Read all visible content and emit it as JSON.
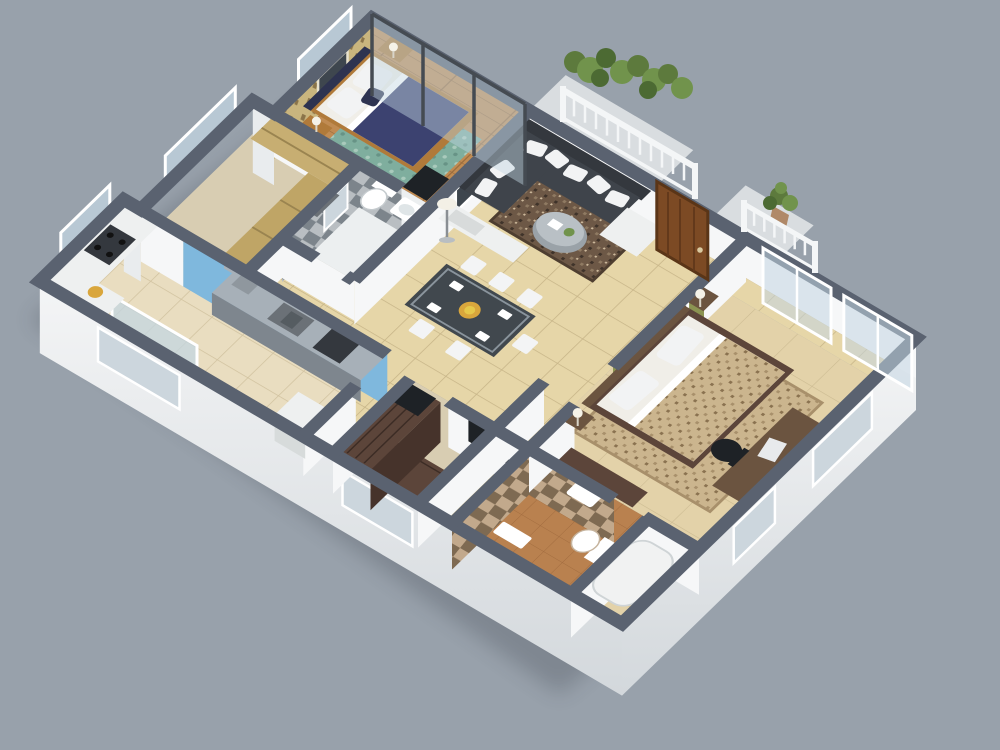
{
  "scene": {
    "type": "3d-isometric-floor-plan-render",
    "rooms": [
      {
        "id": "bedroom-1",
        "floor": "wood",
        "features": [
          "double-bed-navy-duvet",
          "gold-pattern-wallpaper",
          "glass-partition",
          "teal-rug",
          "nightstands",
          "tv"
        ]
      },
      {
        "id": "living-room",
        "floor": "beige-tile",
        "features": [
          "charcoal-corner-sofa",
          "white-pillows",
          "round-coffee-table",
          "brown-rug",
          "tv-console",
          "floor-lamp",
          "wall-art"
        ]
      },
      {
        "id": "balcony",
        "features": [
          "white-railing",
          "planter-shrubs",
          "potted-plant"
        ]
      },
      {
        "id": "entry",
        "features": [
          "wood-door"
        ]
      },
      {
        "id": "dining-area",
        "floor": "beige-tile",
        "features": [
          "glass-dining-table",
          "white-chairs",
          "fruit-plate"
        ]
      },
      {
        "id": "kitchen",
        "floor": "beige-tile",
        "features": [
          "blue-backsplash",
          "steel-counter",
          "sink",
          "gas-stove",
          "fridge",
          "fruit-bowl"
        ]
      },
      {
        "id": "bathroom-1",
        "floor": "white-tile",
        "features": [
          "gray-checker-walls",
          "toilet",
          "basin",
          "mirror"
        ]
      },
      {
        "id": "closet-room",
        "features": [
          "tan-cabinets",
          "window"
        ]
      },
      {
        "id": "master-bedroom",
        "floor": "marble",
        "features": [
          "olive-accent-wall",
          "double-bed-brown-duvet",
          "desk",
          "office-chair",
          "tv-panel",
          "beige-rug",
          "facade-windows"
        ]
      },
      {
        "id": "walk-in-wardrobe",
        "features": [
          "espresso-l-shaped-unit"
        ]
      },
      {
        "id": "bathroom-2",
        "floor": "terracotta",
        "features": [
          "brown-checker-walls",
          "toilet",
          "basin",
          "tub"
        ]
      }
    ]
  },
  "palette": {
    "bg": "#98a1ab",
    "shadow": "#262c34",
    "wall_top": "#5a6270",
    "wall_inner": "#f6f7f8",
    "step_face": "#e9ecee",
    "facade_window": "#ccd6dd",
    "floor_tile": "#e6d6a8",
    "floor_tile_light": "#e9ddc0",
    "floor_wood": "#c08b52",
    "floor_marble": "#e3d2a9",
    "floor_bath": "#eceff0",
    "floor_terracotta": "#b9814f",
    "floor_walkin": "#d8cdb2",
    "balcony_floor": "#d9dde0",
    "rug_teal": "#7fae9e",
    "rug_brown": "#6d5846",
    "rug_master": "#cbb58e",
    "sofa": "#3f444b",
    "sofa_dark": "#34383e",
    "pillow": "#f2f3f4",
    "bed1_duvet": "#3c4270",
    "bed1_head": "#2e3350",
    "bed2_duvet": "#8f7f5c",
    "mattress": "#f0eee8",
    "wood_furniture": "#b07a3a",
    "wood_dark": "#6b5440",
    "espresso": "#5c453a",
    "espresso_face": "#46332b",
    "green_wall": "#8b9352",
    "blue_wall": "#7fb8dd",
    "counter_steel": "#a7b0b8",
    "counter_steel_dark": "#7e868e",
    "steel_dark": "#6b7177",
    "cabinet_tan": "#c7ae72",
    "cabinet_tan_dark": "#bfa566",
    "white_furniture": "#eef0f0",
    "door_wood": "#7c4a24",
    "door_frame": "#5a3517",
    "railing": "#f4f6f7",
    "plant_dark": "#4c6a33",
    "plant_mid": "#5d7a3d",
    "plant_light": "#71934c",
    "glass": "#c3d6e2",
    "glass_frame": "#454b52",
    "checker_gray_a": "#b9bec2",
    "checker_gray_b": "#7c848b",
    "checker_brown_a": "#c2a98c",
    "checker_brown_b": "#7e6a52",
    "wallpaper_a": "#c9b57e",
    "wallpaper_b": "#8a744a",
    "art_dark": "#3e464e",
    "frame_white": "#f4f5f6",
    "tv_dark": "#1e2226",
    "fruit": "#d9a63c",
    "fruit_light": "#e6c84a",
    "table_glass": "#41484e",
    "chair_white": "#f3f4f5",
    "pot_clay": "#b08968"
  }
}
